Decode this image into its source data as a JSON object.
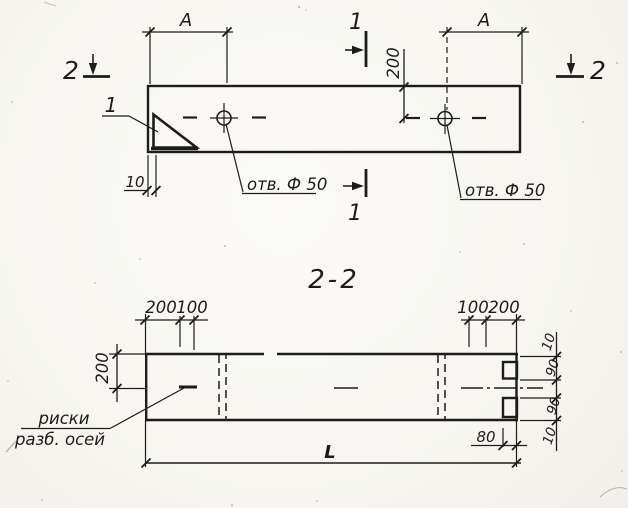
{
  "palette": {
    "ink": "#1d1c1a",
    "paper": "#f7f6f1"
  },
  "plan_view": {
    "section1_top_label": "1",
    "section1_bottom_label": "1",
    "section2_left_label": "2",
    "section2_right_label": "2",
    "dim_a_left": "A",
    "dim_a_right": "A",
    "dim_hole_offset": "200",
    "dim_edge_gap": "10",
    "corner_callout": "1",
    "hole_label_left": "отв. Ф 50",
    "hole_label_right": "отв. Ф 50"
  },
  "section_view": {
    "title": "2-2",
    "dim_left_vertical": "200",
    "dim_top_left_outer": "200",
    "dim_top_left_inner": "100",
    "dim_top_right_inner": "100",
    "dim_top_right_outer": "200",
    "dim_right_top_edge": "10",
    "dim_right_notch_top": "90",
    "dim_right_notch_bottom": "90",
    "dim_right_bottom_edge": "10",
    "dim_notch_depth": "80",
    "dim_overall_length": "L",
    "axes_note_line1": "риски",
    "axes_note_line2": "разб. осей"
  }
}
